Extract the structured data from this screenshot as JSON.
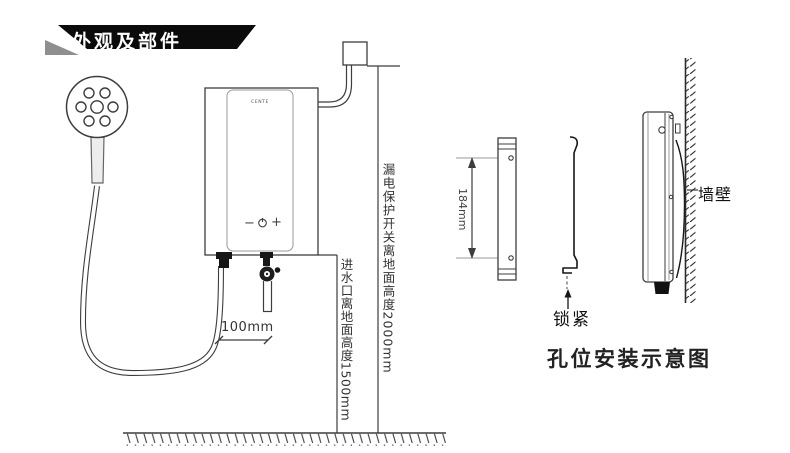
{
  "banner": {
    "title": "外观及部件"
  },
  "left_diagram": {
    "labels": {
      "breaker_height": "漏电保护开关离地面高度2000mm",
      "inlet_height": "进水口离地面高度1500mm",
      "pipe_spacing": "100mm",
      "brand_logo": "CENTE",
      "control_minus": "−",
      "control_plus": "+"
    }
  },
  "right_diagram": {
    "labels": {
      "hole_distance": "184mm",
      "lock": "锁紧",
      "wall": "墙壁"
    },
    "caption": "孔位安装示意图"
  },
  "colors": {
    "line": "#3d3d3d",
    "light_line": "#999999",
    "ink": "#111111"
  }
}
